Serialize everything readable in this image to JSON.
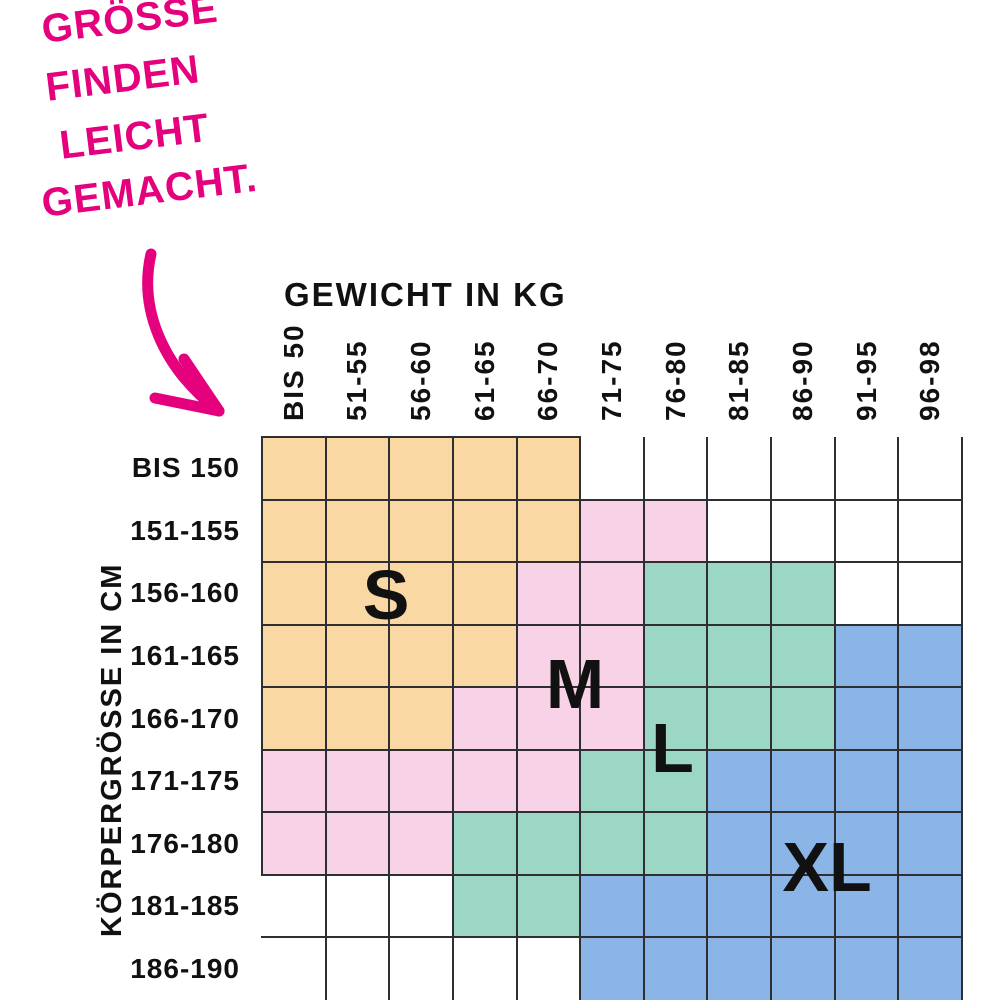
{
  "tagline": {
    "lines": [
      "GRÖSSE",
      "FINDEN",
      "LEICHT",
      "GEMACHT."
    ]
  },
  "colors": {
    "accent": "#E5007E",
    "line": "#2F2F33",
    "text": "#111111"
  },
  "chart_data": {
    "type": "heatmap",
    "x_title": "GEWICHT IN KG",
    "y_title": "KÖRPERGRÖSSE IN CM",
    "x_categories": [
      "BIS 50",
      "51-55",
      "56-60",
      "61-65",
      "66-70",
      "71-75",
      "76-80",
      "81-85",
      "86-90",
      "91-95",
      "96-98"
    ],
    "y_categories": [
      "BIS 150",
      "151-155",
      "156-160",
      "161-165",
      "166-170",
      "171-175",
      "176-180",
      "181-185",
      "186-190"
    ],
    "zones": [
      "S",
      "M",
      "L",
      "XL"
    ],
    "zone_colors": {
      "S": "#F9D8A3",
      "M": "#F8D2E6",
      "L": "#9BD7C4",
      "XL": "#8BB5E6"
    },
    "matrix": [
      [
        "S",
        "S",
        "S",
        "S",
        "S",
        "",
        "",
        "",
        "",
        "",
        ""
      ],
      [
        "S",
        "S",
        "S",
        "S",
        "S",
        "M",
        "M",
        "",
        "",
        "",
        ""
      ],
      [
        "S",
        "S",
        "S",
        "S",
        "M",
        "M",
        "L",
        "L",
        "L",
        "",
        ""
      ],
      [
        "S",
        "S",
        "S",
        "S",
        "M",
        "M",
        "L",
        "L",
        "L",
        "XL",
        "XL"
      ],
      [
        "S",
        "S",
        "S",
        "M",
        "M",
        "M",
        "L",
        "L",
        "L",
        "XL",
        "XL"
      ],
      [
        "M",
        "M",
        "M",
        "M",
        "M",
        "L",
        "L",
        "XL",
        "XL",
        "XL",
        "XL"
      ],
      [
        "M",
        "M",
        "M",
        "L",
        "L",
        "L",
        "L",
        "XL",
        "XL",
        "XL",
        "XL"
      ],
      [
        "",
        "",
        "",
        "L",
        "L",
        "XL",
        "XL",
        "XL",
        "XL",
        "XL",
        "XL"
      ],
      [
        "",
        "",
        "",
        "",
        "",
        "XL",
        "XL",
        "XL",
        "XL",
        "XL",
        "XL"
      ]
    ],
    "size_labels": [
      {
        "text": "S",
        "col": 1.95,
        "row": 2.52
      },
      {
        "text": "M",
        "col": 4.92,
        "row": 3.95
      },
      {
        "text": "L",
        "col": 6.45,
        "row": 4.97
      },
      {
        "text": "XL",
        "col": 8.88,
        "row": 6.88
      }
    ]
  }
}
